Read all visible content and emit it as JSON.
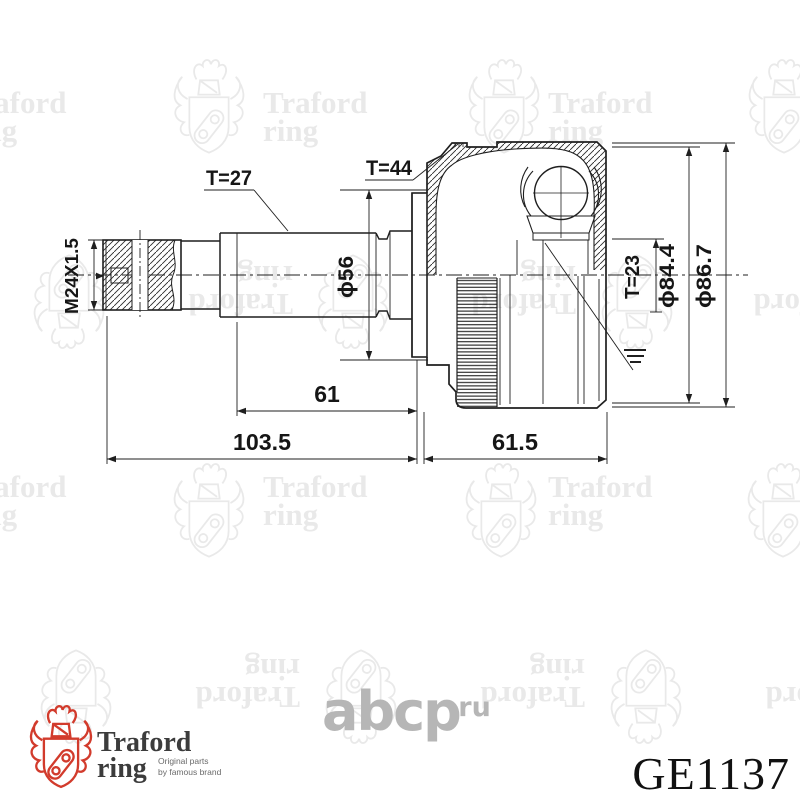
{
  "watermark": {
    "line1": "Traford",
    "line2": "ring"
  },
  "abcp_logo": {
    "text": "abcp",
    "suffix": ".ru"
  },
  "brand_logo": {
    "title_line1": "Traford",
    "title_line2": "ring",
    "tagline_line1": "Original parts",
    "tagline_line2": "by famous brand"
  },
  "part_number": "GE1137",
  "drawing": {
    "type": "CV joint outer technical drawing",
    "dim_labels": {
      "spline_shaft_teeth": "T=27",
      "abs_ring_teeth": "T=44",
      "thread": "M24X1.5",
      "boot_diameter": "ϕ56",
      "inner_spline_teeth": "T=23",
      "diameter_84_4": "ϕ84.4",
      "diameter_86_7": "ϕ86.7",
      "spline_length": "61",
      "shaft_length": "103.5",
      "housing_length": "61.5"
    }
  },
  "colors": {
    "line": "#1f1f1f",
    "watermark_gray": "#e9e9e9",
    "abcp_gray": "#b6b6b6",
    "brand_red": "#d23b2c",
    "brand_text": "#3c3c3c",
    "part_number": "#111111"
  }
}
